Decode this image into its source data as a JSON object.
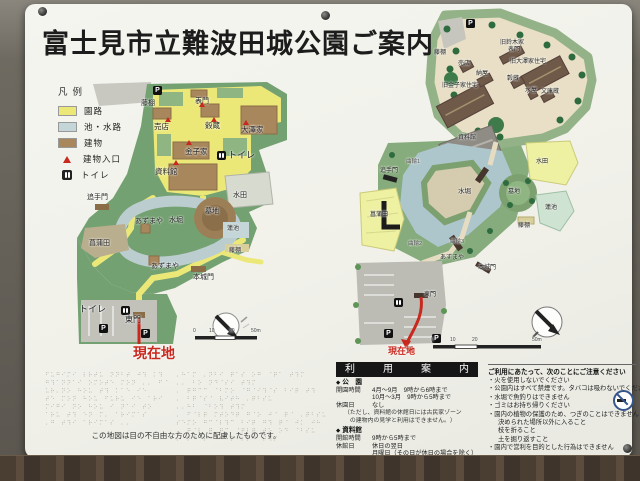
{
  "sign": {
    "title": "富士見市立難波田城公園ご案内"
  },
  "legend": {
    "heading": "凡例",
    "items": [
      {
        "type": "swatch",
        "color": "#ece878",
        "label": "園路"
      },
      {
        "type": "swatch",
        "color": "#c5d6d8",
        "label": "池・水路"
      },
      {
        "type": "swatch",
        "color": "#a8875c",
        "label": "建物"
      },
      {
        "type": "tri",
        "color": "#c8281e",
        "label": "建物入口"
      },
      {
        "type": "wc",
        "label": "トイレ"
      }
    ]
  },
  "left_map": {
    "labels": [
      {
        "type": "p",
        "x": 98,
        "y": 8
      },
      {
        "t": "藤棚",
        "x": 86,
        "y": 22,
        "s": 7
      },
      {
        "t": "表門",
        "x": 140,
        "y": 20,
        "s": 7
      },
      {
        "t": "売店",
        "x": 99,
        "y": 45,
        "s": 7.5
      },
      {
        "t": "穀蔵",
        "x": 150,
        "y": 44,
        "s": 7.5
      },
      {
        "t": "大澤家",
        "x": 186,
        "y": 48,
        "s": 7.5
      },
      {
        "t": "金子家",
        "x": 130,
        "y": 70,
        "s": 7.5
      },
      {
        "type": "wc",
        "x": 162,
        "y": 73
      },
      {
        "t": "トイレ",
        "x": 173,
        "y": 73,
        "s": 9
      },
      {
        "t": "資料館",
        "x": 100,
        "y": 90,
        "s": 7.5
      },
      {
        "t": "追手門",
        "x": 32,
        "y": 116,
        "s": 7
      },
      {
        "t": "あずまや",
        "x": 80,
        "y": 140,
        "s": 7
      },
      {
        "t": "水堀",
        "x": 114,
        "y": 139,
        "s": 7
      },
      {
        "t": "墓地",
        "x": 150,
        "y": 130,
        "s": 7
      },
      {
        "t": "水田",
        "x": 178,
        "y": 114,
        "s": 7
      },
      {
        "t": "蓮池",
        "x": 172,
        "y": 148,
        "s": 6
      },
      {
        "t": "藤棚",
        "x": 174,
        "y": 170,
        "s": 6
      },
      {
        "t": "菖蒲田",
        "x": 34,
        "y": 162,
        "s": 7
      },
      {
        "t": "あずまや",
        "x": 96,
        "y": 185,
        "s": 7
      },
      {
        "t": "本城門",
        "x": 138,
        "y": 196,
        "s": 7
      },
      {
        "t": "トイレ",
        "x": 24,
        "y": 227,
        "s": 9
      },
      {
        "type": "wc",
        "x": 66,
        "y": 228
      },
      {
        "t": "東門",
        "x": 70,
        "y": 238,
        "s": 8
      },
      {
        "type": "p",
        "x": 44,
        "y": 246
      },
      {
        "type": "p",
        "x": 86,
        "y": 251
      },
      {
        "type": "tri",
        "x": 144,
        "y": 24
      },
      {
        "type": "tri",
        "x": 110,
        "y": 39
      },
      {
        "type": "tri",
        "x": 156,
        "y": 39
      },
      {
        "type": "tri",
        "x": 131,
        "y": 62
      },
      {
        "type": "tri",
        "x": 188,
        "y": 42
      },
      {
        "type": "tri",
        "x": 118,
        "y": 82
      },
      {
        "t": "0",
        "x": 138,
        "y": 251,
        "s": 5,
        "c": "#444"
      },
      {
        "t": "10",
        "x": 154,
        "y": 251,
        "s": 5,
        "c": "#444"
      },
      {
        "t": "20",
        "x": 174,
        "y": 251,
        "s": 5,
        "c": "#444"
      },
      {
        "t": "50m",
        "x": 196,
        "y": 251,
        "s": 5,
        "c": "#444"
      },
      {
        "t": "現在地",
        "x": 78,
        "y": 268,
        "s": 14,
        "c": "#c8281e",
        "b": 1
      }
    ]
  },
  "right_map": {
    "labels": [
      {
        "type": "p",
        "x": 116,
        "y": 14
      },
      {
        "t": "藤棚",
        "x": 84,
        "y": 45,
        "s": 6
      },
      {
        "t": "売店",
        "x": 108,
        "y": 56,
        "s": 6
      },
      {
        "t": "納屋",
        "x": 126,
        "y": 66,
        "s": 6
      },
      {
        "t": "旧鈴木家",
        "x": 150,
        "y": 35,
        "s": 6
      },
      {
        "t": "表門",
        "x": 158,
        "y": 42,
        "s": 6
      },
      {
        "t": "旧大澤家住宅",
        "x": 160,
        "y": 54,
        "s": 6
      },
      {
        "t": "穀蔵",
        "x": 157,
        "y": 71,
        "s": 6
      },
      {
        "t": "水屋",
        "x": 175,
        "y": 83,
        "s": 6
      },
      {
        "t": "文庫蔵",
        "x": 191,
        "y": 84,
        "s": 6
      },
      {
        "t": "旧金子家住宅",
        "x": 92,
        "y": 78,
        "s": 6
      },
      {
        "t": "資料館",
        "x": 108,
        "y": 130,
        "s": 6
      },
      {
        "t": "水堀",
        "x": 108,
        "y": 184,
        "s": 6.5
      },
      {
        "t": "墓地",
        "x": 158,
        "y": 184,
        "s": 6
      },
      {
        "t": "水田",
        "x": 186,
        "y": 154,
        "s": 6
      },
      {
        "t": "蓮池",
        "x": 195,
        "y": 200,
        "s": 6
      },
      {
        "t": "藤棚",
        "x": 168,
        "y": 218,
        "s": 6
      },
      {
        "t": "菖蒲田",
        "x": 20,
        "y": 207,
        "s": 6
      },
      {
        "t": "追手門",
        "x": 30,
        "y": 163,
        "s": 6
      },
      {
        "t": "曲輪1",
        "x": 56,
        "y": 155,
        "s": 5.5,
        "c": "#555"
      },
      {
        "t": "曲輪2",
        "x": 58,
        "y": 237,
        "s": 5.5,
        "c": "#555"
      },
      {
        "t": "曲輪3",
        "x": 100,
        "y": 235,
        "s": 5.5,
        "c": "#555"
      },
      {
        "t": "あずまや",
        "x": 90,
        "y": 250,
        "s": 6
      },
      {
        "t": "本城門",
        "x": 128,
        "y": 260,
        "s": 6
      },
      {
        "t": "東門",
        "x": 74,
        "y": 287,
        "s": 6
      },
      {
        "type": "wc",
        "x": 44,
        "y": 293
      },
      {
        "type": "p",
        "x": 34,
        "y": 324
      },
      {
        "type": "p",
        "x": 82,
        "y": 329
      },
      {
        "t": "0",
        "x": 81,
        "y": 333,
        "s": 5,
        "c": "#444"
      },
      {
        "t": "10",
        "x": 100,
        "y": 333,
        "s": 5,
        "c": "#444"
      },
      {
        "t": "20",
        "x": 122,
        "y": 333,
        "s": 5,
        "c": "#444"
      },
      {
        "t": "50m",
        "x": 182,
        "y": 333,
        "s": 5,
        "c": "#444"
      },
      {
        "t": "現在地",
        "x": 38,
        "y": 342,
        "s": 9,
        "c": "#c8281e",
        "b": 1
      }
    ]
  },
  "braille": {
    "left_lines": [
      "⠋⠥⠛⠊⠍⠊⠀⠇⠗⠞⠥⠀⠝⠝⠃⠞⠀⠚⠹⠀⠅⠹",
      "⠛⠹⠁⠝⠝⠁⠊⠀⠕⠍⠕⠞⠑⠀⠍⠕⠝⠀⠄⠄⠀⠋⠈",
      "⠥⠗⠄⠝⠕⠀⠓⠕⠥⠀⠞⠹⠀⠅⠁⠑⠀⠊⠑",
      "⠞⠑⠀⠍⠕⠝⠀⠓⠕⠥⠀⠋⠥⠗⠥⠀⠊⠑⠀⠁⠗⠊",
      "⠍⠊⠛⠊⠀⠝⠕⠀⠓⠕⠥⠀⠊⠀⠝⠁⠊⠀⠞⠕",
      "⠁⠗⠥⠀⠞⠹⠀⠑⠝⠀⠍⠄⠀⠁⠗⠊⠍⠁⠎",
      "⠄⠛⠀⠞⠹⠊⠀⠁⠗⠊⠍⠁⠎⠀⠄⠄"
    ],
    "right_lines": [
      "⠄⠓⠁⠍⠀⠄⠝⠃⠊⠀⠟⠁⠎⠀⠕⠛⠀⠈⠟⠁⠀⠞⠹⠍",
      "⠄⠄⠀⠃⠕⠀⠝⠙⠈⠎⠊⠀⠞⠹⠍",
      "⠄⠀⠟⠛⠉⠉⠀⠈⠃⠍⠕⠀⠈⠛⠈⠊⠹⠈⠎⠀⠃⠊⠟⠀⠞⠹",
      "⠄⠀⠃⠟⠈⠎⠈⠀⠧⠊⠞⠓⠀⠄⠟⠃⠎⠥",
      "⠄⠄⠓⠃⠀⠈⠃⠕⠹⠀⠞⠹⠍",
      "⠄⠀⠋⠈⠇⠟⠀⠍⠞⠕⠙⠟⠀⠛⠈⠕⠀⠚⠈⠀⠟⠈⠀⠄⠟⠃⠎⠥⠀⠤⠤",
      "⠎⠑⠍⠕⠀⠛⠉⠈⠇⠹⠉⠀⠃⠊⠟⠀⠛⠹⠀⠟⠈⠀⠚⠅⠀⠚⠓⠀⠛⠅⠟⠎⠀⠕⠛",
      "⠄⠀⠟⠈⠇⠀⠟⠀⠟⠉⠀⠈⠟⠇⠟⠀⠞⠕⠀⠕⠙⠀⠈⠃⠎⠥",
      "⠄⠀⠕⠙⠈⠇⠀⠘⠓⠁⠍⠀⠄⠟⠃⠀⠞⠹⠍"
    ],
    "note": "この地図は目の不自由な方のために配慮したものです。"
  },
  "info": {
    "header": "利　用　案　内",
    "sections": [
      {
        "name": "公　園",
        "rows": [
          {
            "k": "開園時間",
            "v": "4月～9月　9時から6時まで"
          },
          {
            "k": "",
            "v": "10月～3月　9時から5時まで"
          },
          {
            "k": "休園日",
            "v": "なし"
          }
        ],
        "note1": "（ただし、資料館の休館日には古民家ゾーン",
        "note2": "　の建物内の見学と利用はできません。）"
      },
      {
        "name": "資料館",
        "rows": [
          {
            "k": "開館時間",
            "v": "9時から5時まで"
          },
          {
            "k": "休館日",
            "v": "休日の翌日"
          },
          {
            "k": "",
            "v": "月曜日（その日が休日の場合を除く）"
          },
          {
            "k": "",
            "v": "年末年始"
          }
        ],
        "note1": "",
        "note2": ""
      }
    ],
    "notice": {
      "heading": "ご利用にあたって、次のことにご注意ください",
      "items": [
        {
          "t": "火を使用しないでください",
          "sub": false
        },
        {
          "t": "公園内はすべて禁煙です。タバコは吸わないでください",
          "sub": false
        },
        {
          "t": "水堀で魚釣りはできません",
          "sub": false
        },
        {
          "t": "ゴミはお持ち帰りください",
          "sub": false
        },
        {
          "t": "園内の植物の保護のため、つぎのことはできません",
          "sub": false
        },
        {
          "t": "決められた場所以外に入ること",
          "sub": true
        },
        {
          "t": "枝を折ること",
          "sub": true
        },
        {
          "t": "土を掘り返すこと",
          "sub": true
        },
        {
          "t": "園内で営利を目的とした行為はできません",
          "sub": false
        }
      ]
    }
  },
  "colors": {
    "path_yellow": "#ece878",
    "water": "#c5d6d8",
    "building_brown": "#a8875c",
    "accent_red": "#c8281e",
    "map_green": "#74a172",
    "detail_cream": "#e8dfc6"
  }
}
